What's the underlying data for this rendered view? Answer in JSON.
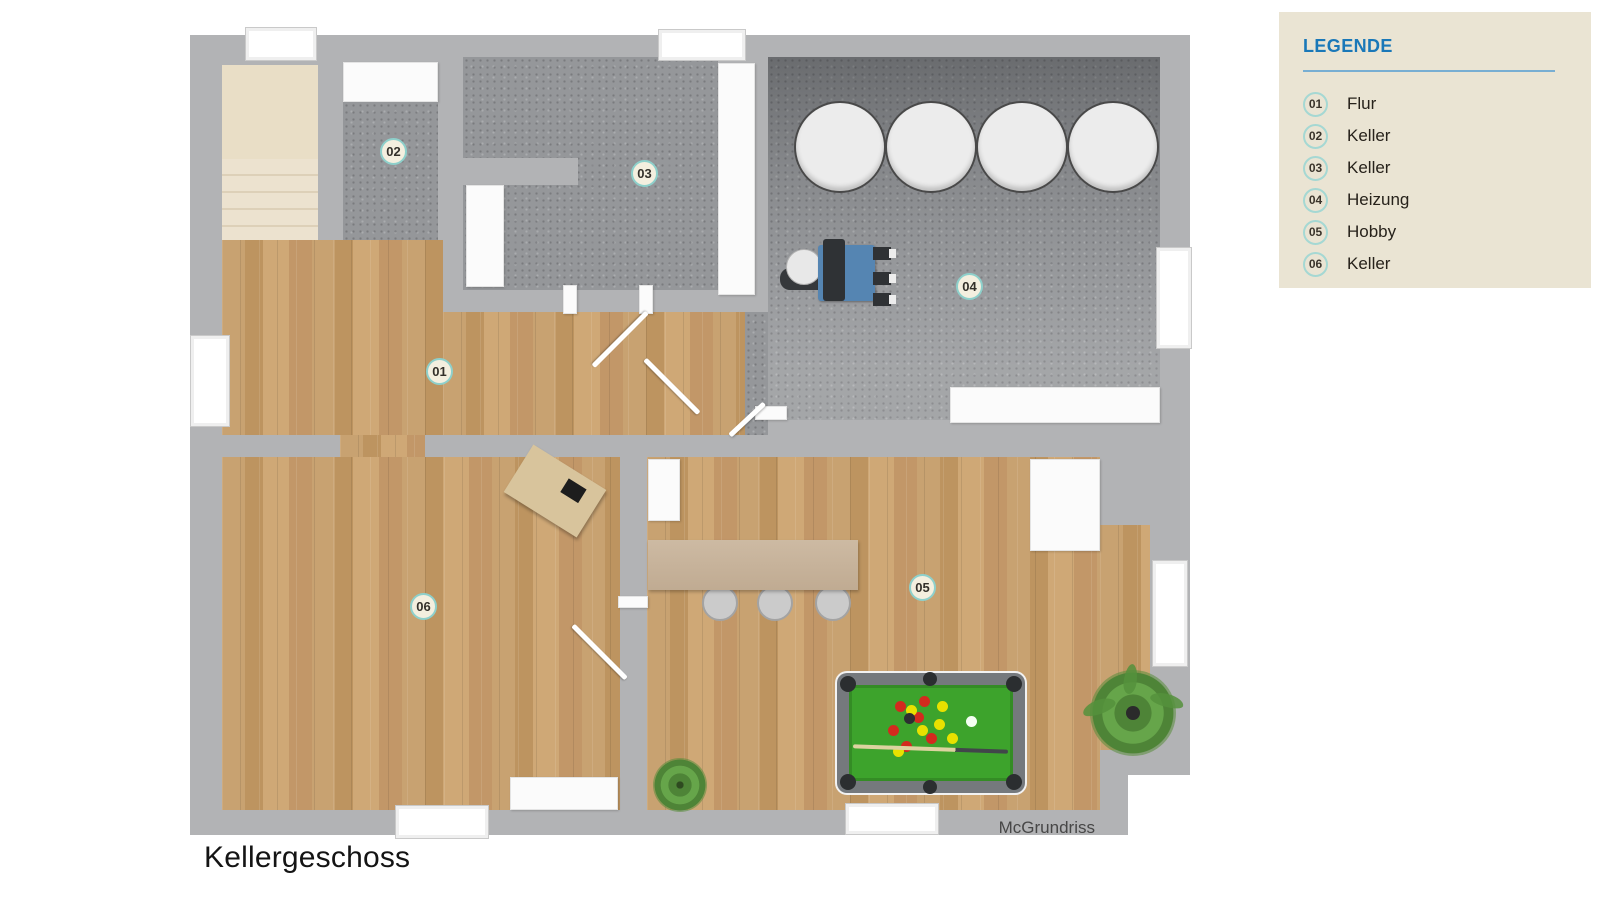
{
  "page": {
    "title": "Kellergeschoss",
    "watermark": "McGrundriss"
  },
  "legend": {
    "title": "LEGENDE",
    "items": [
      {
        "number": "01",
        "label": "Flur"
      },
      {
        "number": "02",
        "label": "Keller"
      },
      {
        "number": "03",
        "label": "Keller"
      },
      {
        "number": "04",
        "label": "Heizung"
      },
      {
        "number": "05",
        "label": "Hobby"
      },
      {
        "number": "06",
        "label": "Keller"
      }
    ]
  },
  "markers": [
    {
      "number": "01"
    },
    {
      "number": "02"
    },
    {
      "number": "03"
    },
    {
      "number": "04"
    },
    {
      "number": "05"
    },
    {
      "number": "06"
    }
  ],
  "colors": {
    "wall": "#b2b3b5",
    "wood_floor": "#c49b6b",
    "concrete_floor": "#95979a",
    "stairs": "#efe7d7",
    "legend_panel": "#eae4d3",
    "legend_title": "#1a78b8",
    "marker_ring": "#8ed0cb",
    "pool_felt": "#3da32c",
    "boiler_blue": "#5585b2",
    "tank": "#ececec"
  }
}
